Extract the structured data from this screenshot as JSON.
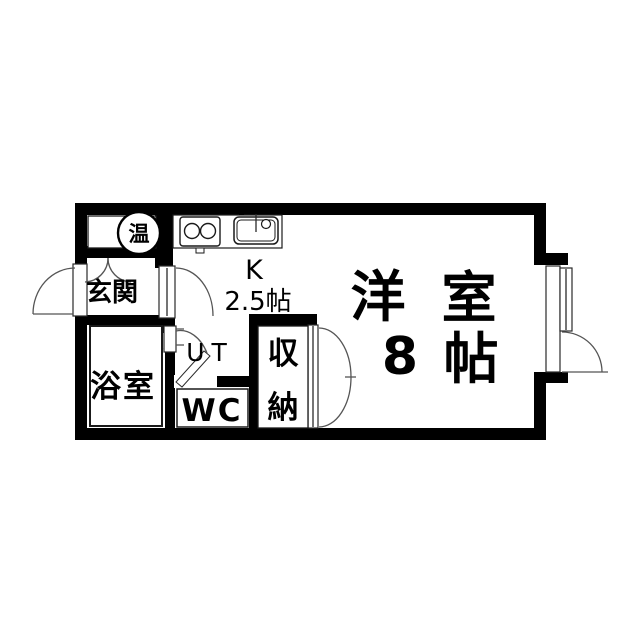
{
  "title": "apartment-floor-plan",
  "colors": {
    "wall": "#000000",
    "background": "#ffffff",
    "outline": "#1a1a1a",
    "door_arc": "#555555"
  },
  "rooms": {
    "water_heater": {
      "label": "温"
    },
    "entrance": {
      "label": "玄関"
    },
    "bathroom": {
      "label": "浴室"
    },
    "utility": {
      "label": "UT"
    },
    "toilet": {
      "label": "WC"
    },
    "storage": {
      "char_top": "収",
      "char_bottom": "納"
    },
    "kitchen": {
      "label": "K",
      "size": "2.5帖"
    },
    "living": {
      "char_1": "洋",
      "char_2": "室",
      "size_num": "8",
      "size_unit": "帖"
    }
  }
}
